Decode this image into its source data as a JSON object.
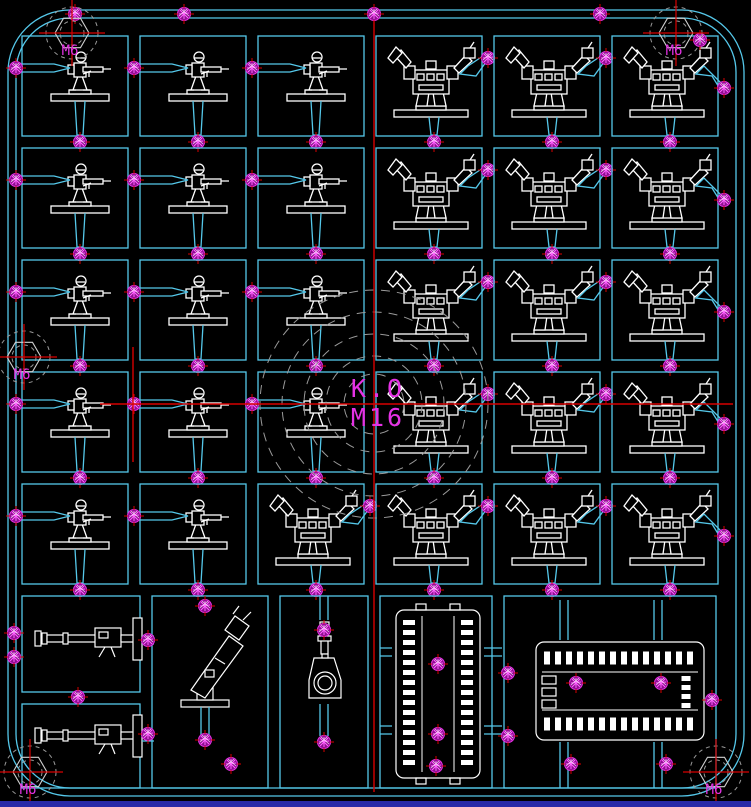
{
  "canvas": {
    "width": 751,
    "height": 807
  },
  "labels": {
    "center_line1": "K.O",
    "center_line2": "M16",
    "bolt_hole": "M6"
  },
  "colors": {
    "background": "#000000",
    "runner_cyan": "#55c8ea",
    "entity_white": "#ffffff",
    "gate_magenta": "#e532e5",
    "gate_fill": "#8f0e8f",
    "gate_hatch": "#ff66ff",
    "centerline_red": "#d80000",
    "datum_gray": "#9a9a9a",
    "label_magenta": "#e532e5",
    "bottom_strip_blue": "#2929a8"
  },
  "sprue": {
    "outer": {
      "x": 8,
      "y": 10,
      "w": 736,
      "h": 786,
      "r": 62
    },
    "inner": {
      "x": 16,
      "y": 18,
      "w": 720,
      "h": 770,
      "r": 54
    }
  },
  "grid": {
    "origin_x": 22,
    "origin_y": 36,
    "cell_w": 106,
    "cell_h": 100,
    "pitch_x": 118,
    "pitch_y": 112,
    "cols": 6,
    "rows": 5
  },
  "cell_types": [
    [
      "soldier",
      "soldier",
      "soldier",
      "robot",
      "robot",
      "robot"
    ],
    [
      "soldier",
      "soldier",
      "soldier",
      "robot",
      "robot",
      "robot"
    ],
    [
      "soldier",
      "soldier",
      "soldier",
      "robot",
      "robot",
      "robot"
    ],
    [
      "soldier",
      "soldier",
      "soldier",
      "robot",
      "robot",
      "robot"
    ],
    [
      "soldier",
      "soldier",
      "robot",
      "robot",
      "robot",
      "robot"
    ]
  ],
  "bottom_cells": [
    {
      "x": 22,
      "y": 596,
      "w": 118,
      "h": 96
    },
    {
      "x": 22,
      "y": 704,
      "w": 118,
      "h": 84
    },
    {
      "x": 152,
      "y": 596,
      "w": 116,
      "h": 192
    },
    {
      "x": 280,
      "y": 596,
      "w": 88,
      "h": 192
    },
    {
      "x": 380,
      "y": 596,
      "w": 112,
      "h": 192
    },
    {
      "x": 504,
      "y": 596,
      "w": 212,
      "h": 192
    }
  ],
  "bottom_pieces": [
    {
      "type": "heavy_gun",
      "x": 35,
      "y": 615
    },
    {
      "type": "heavy_gun",
      "x": 35,
      "y": 712
    },
    {
      "type": "launcher",
      "x": 155,
      "y": 600
    },
    {
      "type": "pistol",
      "x": 300,
      "y": 620
    },
    {
      "type": "track_v",
      "x": 392,
      "y": 608
    },
    {
      "type": "track_h",
      "x": 534,
      "y": 640
    }
  ],
  "bolt_holes": [
    {
      "x": 72,
      "y": 33
    },
    {
      "x": 676,
      "y": 33
    },
    {
      "x": 24,
      "y": 357
    },
    {
      "x": 30,
      "y": 772
    },
    {
      "x": 716,
      "y": 772
    }
  ],
  "center_ring": {
    "x": 374,
    "y": 404,
    "radii": [
      30,
      48,
      70,
      92,
      114
    ]
  },
  "centerlines": {
    "horizontal": {
      "y": 404,
      "x1": 100,
      "x2": 733
    },
    "vertical": {
      "x": 374,
      "y1": 8,
      "y2": 792
    },
    "datum_vertical": {
      "x": 133,
      "y1": 347,
      "y2": 462
    }
  },
  "extra_gates": [
    [
      75,
      14
    ],
    [
      184,
      14
    ],
    [
      374,
      14
    ],
    [
      600,
      14
    ],
    [
      700,
      40
    ],
    [
      148,
      640
    ],
    [
      148,
      734
    ],
    [
      78,
      697
    ],
    [
      205,
      606
    ],
    [
      205,
      740
    ],
    [
      324,
      630
    ],
    [
      324,
      742
    ],
    [
      438,
      664
    ],
    [
      438,
      734
    ],
    [
      508,
      673
    ],
    [
      508,
      736
    ],
    [
      576,
      683
    ],
    [
      661,
      683
    ],
    [
      571,
      764
    ],
    [
      666,
      764
    ],
    [
      231,
      764
    ],
    [
      436,
      766
    ],
    [
      712,
      700
    ],
    [
      14,
      633
    ],
    [
      14,
      657
    ]
  ]
}
